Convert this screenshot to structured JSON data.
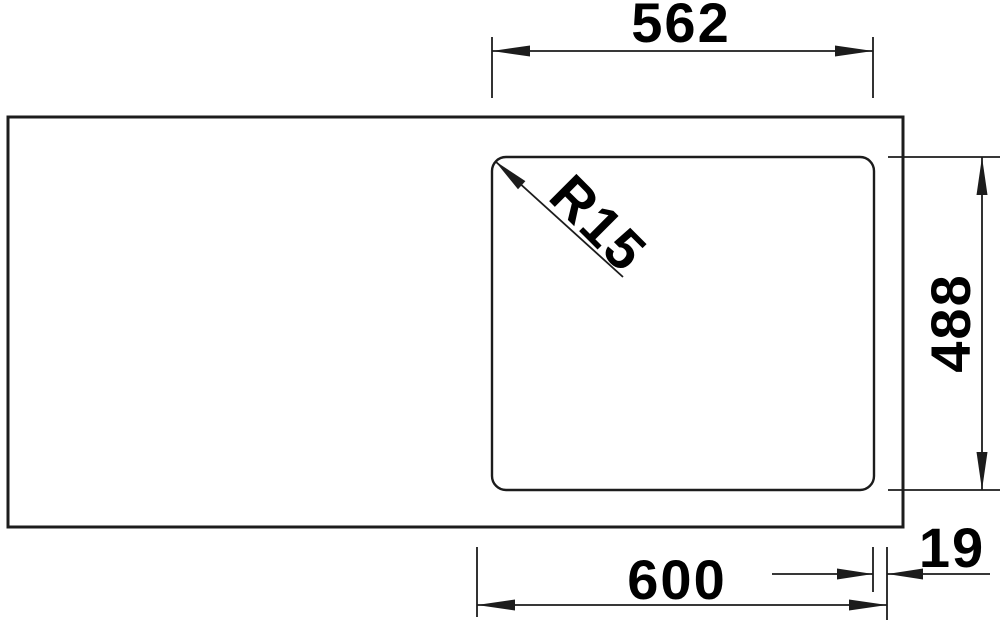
{
  "drawing": {
    "colors": {
      "background": "#ffffff",
      "line": "#1c1c1c",
      "text": "#000000"
    },
    "dimension_labels": {
      "cutout_width_top": "562",
      "corner_radius": "R15",
      "cutout_depth_right": "488",
      "cabinet_width_bottom": "600",
      "edge_offset_right": "19"
    }
  }
}
